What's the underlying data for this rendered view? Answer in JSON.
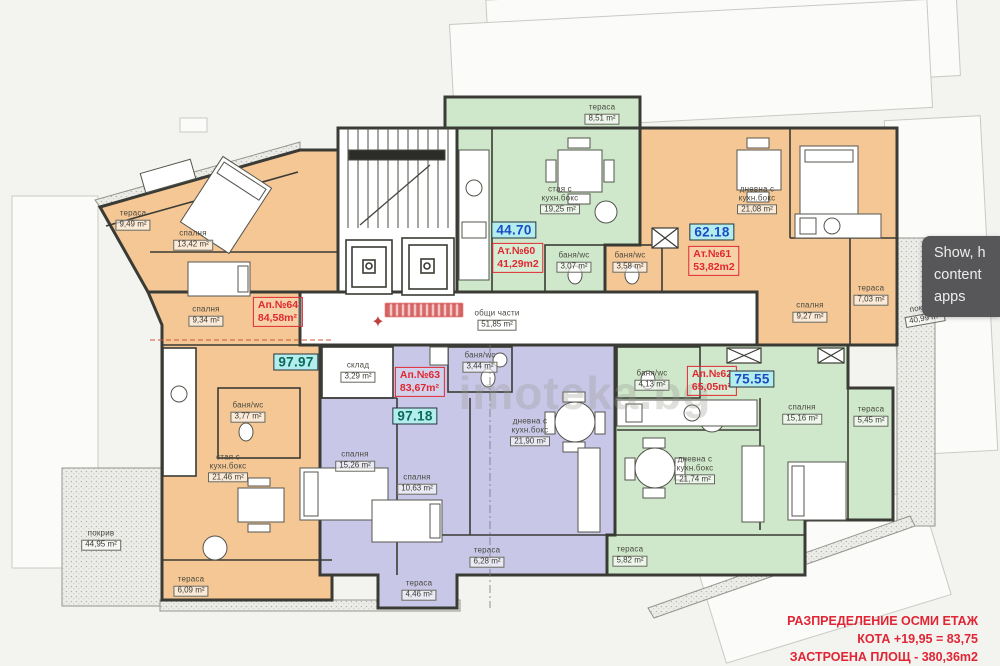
{
  "overlay": {
    "lines": [
      "Show, h",
      "content",
      "apps"
    ]
  },
  "title_block": {
    "line1": "РАЗПРЕДЕЛЕНИЕ  ОСМИ ЕТАЖ",
    "line2": "КОТА +19,95 = 83,75",
    "line3": "ЗАСТРОЕНА ПЛОЩ - 380,36m2"
  },
  "watermark": "imoteka.bg",
  "common_area": {
    "name": "общи части",
    "area": "51,85 m²"
  },
  "roofs": [
    {
      "name": "покрив",
      "area": "44,95 m²"
    },
    {
      "name": "покрив",
      "area": "40,99 m²"
    }
  ],
  "colors": {
    "orange_apartment": "#f5c795",
    "green_apartment": "#cfe8cb",
    "purple_apartment": "#c9c7e8",
    "badge_background": "#b4edee",
    "badge_text_blue": "#1a4cc4",
    "badge_text_teal": "#0b6a58",
    "red_label": "#e02830",
    "wall": "#3b3b35"
  },
  "apartments": [
    {
      "label": "Ат.№60",
      "area": "41,29m2",
      "total": "44.70",
      "color": "#cfe8cb",
      "rooms": [
        {
          "name": "тераса",
          "area": "8,51 m²"
        },
        {
          "name": "стая с кухн.бокс",
          "area": "19,25 m²"
        },
        {
          "name": "баня/wc",
          "area": "3,07 m²"
        }
      ]
    },
    {
      "label": "Ат.№61",
      "area": "53,82m2",
      "total": "62.18",
      "color": "#f5c795",
      "rooms": [
        {
          "name": "дневна с кухн.бокс",
          "area": "21,08 m²"
        },
        {
          "name": "баня/wc",
          "area": "3,58 m²"
        },
        {
          "name": "спалня",
          "area": "9,27 m²"
        },
        {
          "name": "тераса",
          "area": "7,03 m²"
        }
      ]
    },
    {
      "label": "Ап.№62",
      "area": "65,05m²",
      "total": "75.55",
      "color": "#cfe8cb",
      "rooms": [
        {
          "name": "баня/wc",
          "area": "4,13 m²"
        },
        {
          "name": "дневна с кухн.бокс",
          "area": "21,74 m²"
        },
        {
          "name": "спалня",
          "area": "15,16 m²"
        },
        {
          "name": "тераса",
          "area": "5,45 m²"
        },
        {
          "name": "тераса",
          "area": "5,82 m²"
        }
      ]
    },
    {
      "label": "Ап.№63",
      "area": "83,67m²",
      "total": "97.18",
      "color": "#c9c7e8",
      "rooms": [
        {
          "name": "склад",
          "area": "3,29 m²"
        },
        {
          "name": "баня/wc",
          "area": "3,44 m²"
        },
        {
          "name": "спалня",
          "area": "15,26 m²"
        },
        {
          "name": "спалня",
          "area": "10,63 m²"
        },
        {
          "name": "дневна с кухн.бокс",
          "area": "21,90 m²"
        },
        {
          "name": "тераса",
          "area": "6,28 m²"
        },
        {
          "name": "тераса",
          "area": "4,46 m²"
        }
      ]
    },
    {
      "label": "Ап.№64",
      "area": "84,58m²",
      "total": "97.97",
      "color": "#f5c795",
      "rooms": [
        {
          "name": "тераса",
          "area": "9,49 m²"
        },
        {
          "name": "спалня",
          "area": "13,42 m²"
        },
        {
          "name": "спалня",
          "area": "9,34 m²"
        },
        {
          "name": "баня/wc",
          "area": "3,77 m²"
        },
        {
          "name": "стая с кухн.бокс",
          "area": "21,46 m²"
        },
        {
          "name": "тераса",
          "area": "6,09 m²"
        }
      ]
    }
  ]
}
